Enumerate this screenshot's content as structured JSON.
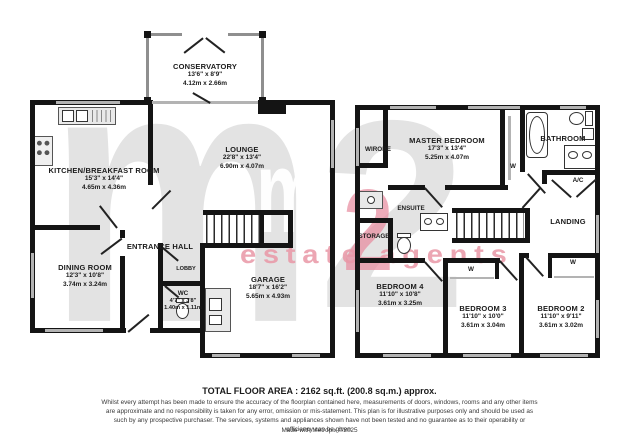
{
  "watermark": {
    "m": "m",
    "two": "2",
    "tagline": "estate agents"
  },
  "colors": {
    "walls": "#141414",
    "watermark_gray": "#e3e3e3",
    "watermark_pink": "#ec9fb1"
  },
  "ground_floor": {
    "conservatory": {
      "name": "CONSERVATORY",
      "imperial": "13'6\" x 8'9\"",
      "metric": "4.12m x 2.66m"
    },
    "kitchen": {
      "name": "KITCHEN/BREAKFAST ROOM",
      "imperial": "15'3\" x 14'4\"",
      "metric": "4.65m x 4.36m"
    },
    "lounge": {
      "name": "LOUNGE",
      "imperial": "22'8\" x 13'4\"",
      "metric": "6.90m x 4.07m"
    },
    "entrance_hall": {
      "name": "ENTRANCE HALL"
    },
    "dining_room": {
      "name": "DINING ROOM",
      "imperial": "12'3\" x 10'8\"",
      "metric": "3.74m x 3.24m"
    },
    "lobby": {
      "name": "LOBBY"
    },
    "wc": {
      "name": "WC",
      "imperial": "4'7\" x 3'8\"",
      "metric": "1.40m x 1.11m"
    },
    "garage": {
      "name": "GARAGE",
      "imperial": "18'7\" x 16'2\"",
      "metric": "5.65m x 4.93m"
    }
  },
  "first_floor": {
    "wirobe": {
      "name": "WIROBE"
    },
    "master_bedroom": {
      "name": "MASTER BEDROOM",
      "imperial": "17'3\" x 13'4\"",
      "metric": "5.25m x 4.07m"
    },
    "master_wardrobe": {
      "name": "W"
    },
    "bathroom": {
      "name": "BATHROOM"
    },
    "airing_cupboard": {
      "name": "A/C"
    },
    "landing": {
      "name": "LANDING"
    },
    "ensuite": {
      "name": "ENSUITE"
    },
    "storage": {
      "name": "STORAGE"
    },
    "bedroom4": {
      "name": "BEDROOM 4",
      "imperial": "11'10\" x 10'8\"",
      "metric": "3.61m x 3.25m"
    },
    "bedroom3": {
      "name": "BEDROOM 3",
      "imperial": "11'10\" x 10'0\"",
      "metric": "3.61m x 3.04m"
    },
    "bedroom2": {
      "name": "BEDROOM 2",
      "imperial": "11'10\" x 9'11\"",
      "metric": "3.61m x 3.02m"
    },
    "bedroom3_wardrobe": {
      "name": "W"
    },
    "bedroom2_wardrobe": {
      "name": "W"
    }
  },
  "footer": {
    "total_area": "TOTAL FLOOR AREA : 2162 sq.ft. (200.8 sq.m.) approx.",
    "disclaimer": "Whilst every attempt has been made to ensure the accuracy of the floorplan contained here, measurements of doors, windows, rooms and any other items are approximate and no responsibility is taken for any error, omission or mis-statement. This plan is for illustrative purposes only and should be used as such by any prospective purchaser. The services, systems and appliances shown have not been tested and no guarantee as to their operability or efficiency can be given.",
    "credit": "Made with Metropix ©2025"
  }
}
